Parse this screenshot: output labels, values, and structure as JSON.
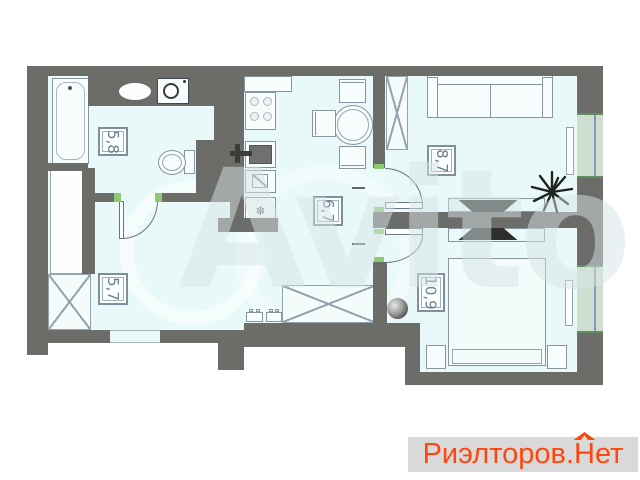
{
  "canvas": {
    "width": 640,
    "height": 480,
    "background": "#ffffff"
  },
  "palette": {
    "wall": "#6c6c69",
    "floor": "#e9f8f8",
    "furniture_line": "#8795a0",
    "accent_green": "#8ccb74",
    "window_pane": "#cfdfcf",
    "window_edge": "#5d8f5f",
    "label_color": "#6b7f8e",
    "label_border": "#7e909d",
    "logo_orange": "#ff470d",
    "logo_bar_bg": "#d9d9d9",
    "dark_item": "#2e2e2c"
  },
  "rooms": [
    {
      "id": "bathroom",
      "area_label": "5,8"
    },
    {
      "id": "kitchen-dining",
      "area_label": "6,7"
    },
    {
      "id": "living-room",
      "area_label": "8,7"
    },
    {
      "id": "hallway",
      "area_label": "5,7"
    },
    {
      "id": "bedroom",
      "area_label": "10,9"
    }
  ],
  "icons": {
    "fridge_snowflake": "❄"
  },
  "watermark": {
    "text": "Avito"
  },
  "footer_logo": {
    "prefix": "Риэлторов.",
    "house_letter": "Н",
    "suffix": "ет"
  }
}
